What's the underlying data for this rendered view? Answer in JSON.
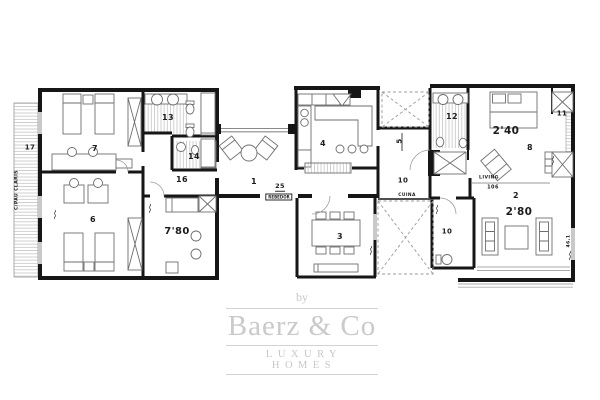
{
  "plan": {
    "street_label": "C/PAU CLARIS",
    "labels": [
      {
        "name": "street",
        "text": "C/PAU CLARIS",
        "x": 18,
        "y": 190,
        "rot": -90,
        "fs": 4.6
      },
      {
        "name": "balcony-17",
        "text": "17",
        "x": 30,
        "y": 148,
        "fs": 7
      },
      {
        "name": "room-7",
        "text": "7",
        "x": 95,
        "y": 149,
        "fs": 8
      },
      {
        "name": "room-13",
        "text": "13",
        "x": 168,
        "y": 118,
        "fs": 8
      },
      {
        "name": "room-14",
        "text": "14",
        "x": 194,
        "y": 157,
        "fs": 8
      },
      {
        "name": "room-16",
        "text": "16",
        "x": 182,
        "y": 180,
        "fs": 8
      },
      {
        "name": "room-6",
        "text": "6",
        "x": 93,
        "y": 220,
        "fs": 8
      },
      {
        "name": "dim-7-80",
        "text": "7'80",
        "x": 177,
        "y": 232,
        "fs": 10
      },
      {
        "name": "room-1",
        "text": "1",
        "x": 254,
        "y": 182,
        "fs": 8
      },
      {
        "name": "room-25",
        "text": "25",
        "x": 280,
        "y": 187,
        "fs": 6.5,
        "underlined": true
      },
      {
        "name": "rebedor",
        "text": "REBEDOR",
        "x": 279,
        "y": 197,
        "fs": 4,
        "boxed": true
      },
      {
        "name": "room-4",
        "text": "4",
        "x": 323,
        "y": 144,
        "fs": 8
      },
      {
        "name": "room-5",
        "text": "5",
        "x": 400,
        "y": 141,
        "rot": -90,
        "fs": 7
      },
      {
        "name": "corridor-10",
        "text": "10",
        "x": 403,
        "y": 181,
        "fs": 7
      },
      {
        "name": "cuina",
        "text": "CUINA",
        "x": 407,
        "y": 196,
        "fs": 4.4
      },
      {
        "name": "room-12",
        "text": "12",
        "x": 452,
        "y": 117,
        "fs": 8
      },
      {
        "name": "dim-2-40",
        "text": "2'40",
        "x": 506,
        "y": 131,
        "fs": 10.5
      },
      {
        "name": "room-11",
        "text": "11",
        "x": 562,
        "y": 114,
        "fs": 7
      },
      {
        "name": "room-8",
        "text": "8",
        "x": 530,
        "y": 148,
        "fs": 8
      },
      {
        "name": "living-label",
        "text": "LIVING",
        "x": 489,
        "y": 179,
        "fs": 4.6
      },
      {
        "name": "living-value",
        "text": "106",
        "x": 493,
        "y": 188,
        "fs": 5
      },
      {
        "name": "room-2",
        "text": "2",
        "x": 516,
        "y": 196,
        "fs": 8
      },
      {
        "name": "dim-2-80",
        "text": "2'80",
        "x": 519,
        "y": 212,
        "fs": 10.5
      },
      {
        "name": "bath-10",
        "text": "10",
        "x": 447,
        "y": 232,
        "fs": 7
      },
      {
        "name": "room-3",
        "text": "3",
        "x": 340,
        "y": 237,
        "fs": 8
      },
      {
        "name": "dim-46-1",
        "text": "46,1",
        "x": 570,
        "y": 241,
        "rot": -90,
        "fs": 4.6
      }
    ]
  },
  "watermark": {
    "prefix": "by",
    "brand": "Baerz & Co",
    "tagline": "LUXURY HOMES",
    "color": "#c7c7c7"
  },
  "colors": {
    "walls": "#161616",
    "furniture": "#6e6e6e",
    "hatch": "#c4c4c4",
    "dashed_patio": "#9a9a9a",
    "window": "#c9c9c9",
    "background": "#ffffff"
  }
}
